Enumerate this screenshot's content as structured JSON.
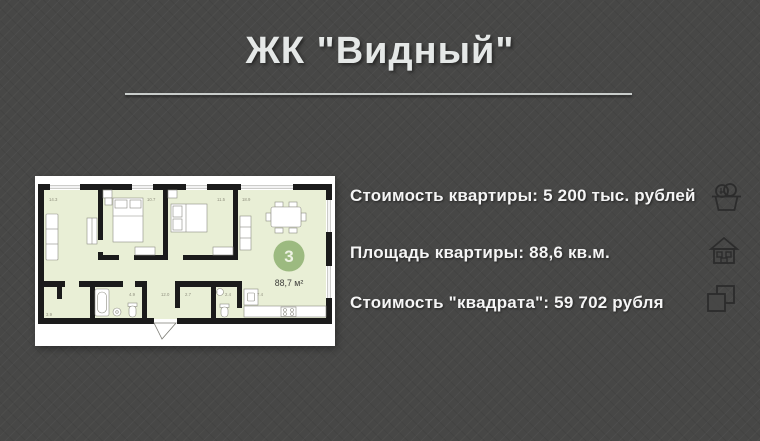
{
  "title": "ЖК \"Видный\"",
  "info": {
    "rows": [
      {
        "text": "Стоимость квартиры: 5 200 тыс. рублей",
        "icon": "money-basket-icon"
      },
      {
        "text": "Площадь квартиры: 88,6 кв.м.",
        "icon": "house-icon"
      },
      {
        "text": "Стоимость \"квадрата\": 59 702 рубля",
        "icon": "overlapping-squares-icon"
      }
    ]
  },
  "floor_plan": {
    "badge_room_count": "3",
    "total_area_label": "88,7 м²",
    "rooms": [
      {
        "name": "living-room",
        "area": "14.3"
      },
      {
        "name": "bedroom-1",
        "area": "10.7"
      },
      {
        "name": "bedroom-2",
        "area": "11.5"
      },
      {
        "name": "kitchen-living-room",
        "area": "18.9"
      },
      {
        "name": "storage",
        "area": "3.9"
      },
      {
        "name": "bathroom",
        "area": "4.9"
      },
      {
        "name": "hallway",
        "area": "12.0"
      },
      {
        "name": "closet",
        "area": "2.7"
      },
      {
        "name": "wc",
        "area": "2.4"
      },
      {
        "name": "kitchen",
        "area": "7.4"
      }
    ]
  },
  "colors": {
    "background": "#474746",
    "title_text": "#e5e8e7",
    "info_text": "#f5f5f5",
    "plan_room_fill": "#e9efd6",
    "plan_wall": "#1b1b1b",
    "badge_green": "#9cba80",
    "icon_stroke": "#2a2a2a"
  }
}
